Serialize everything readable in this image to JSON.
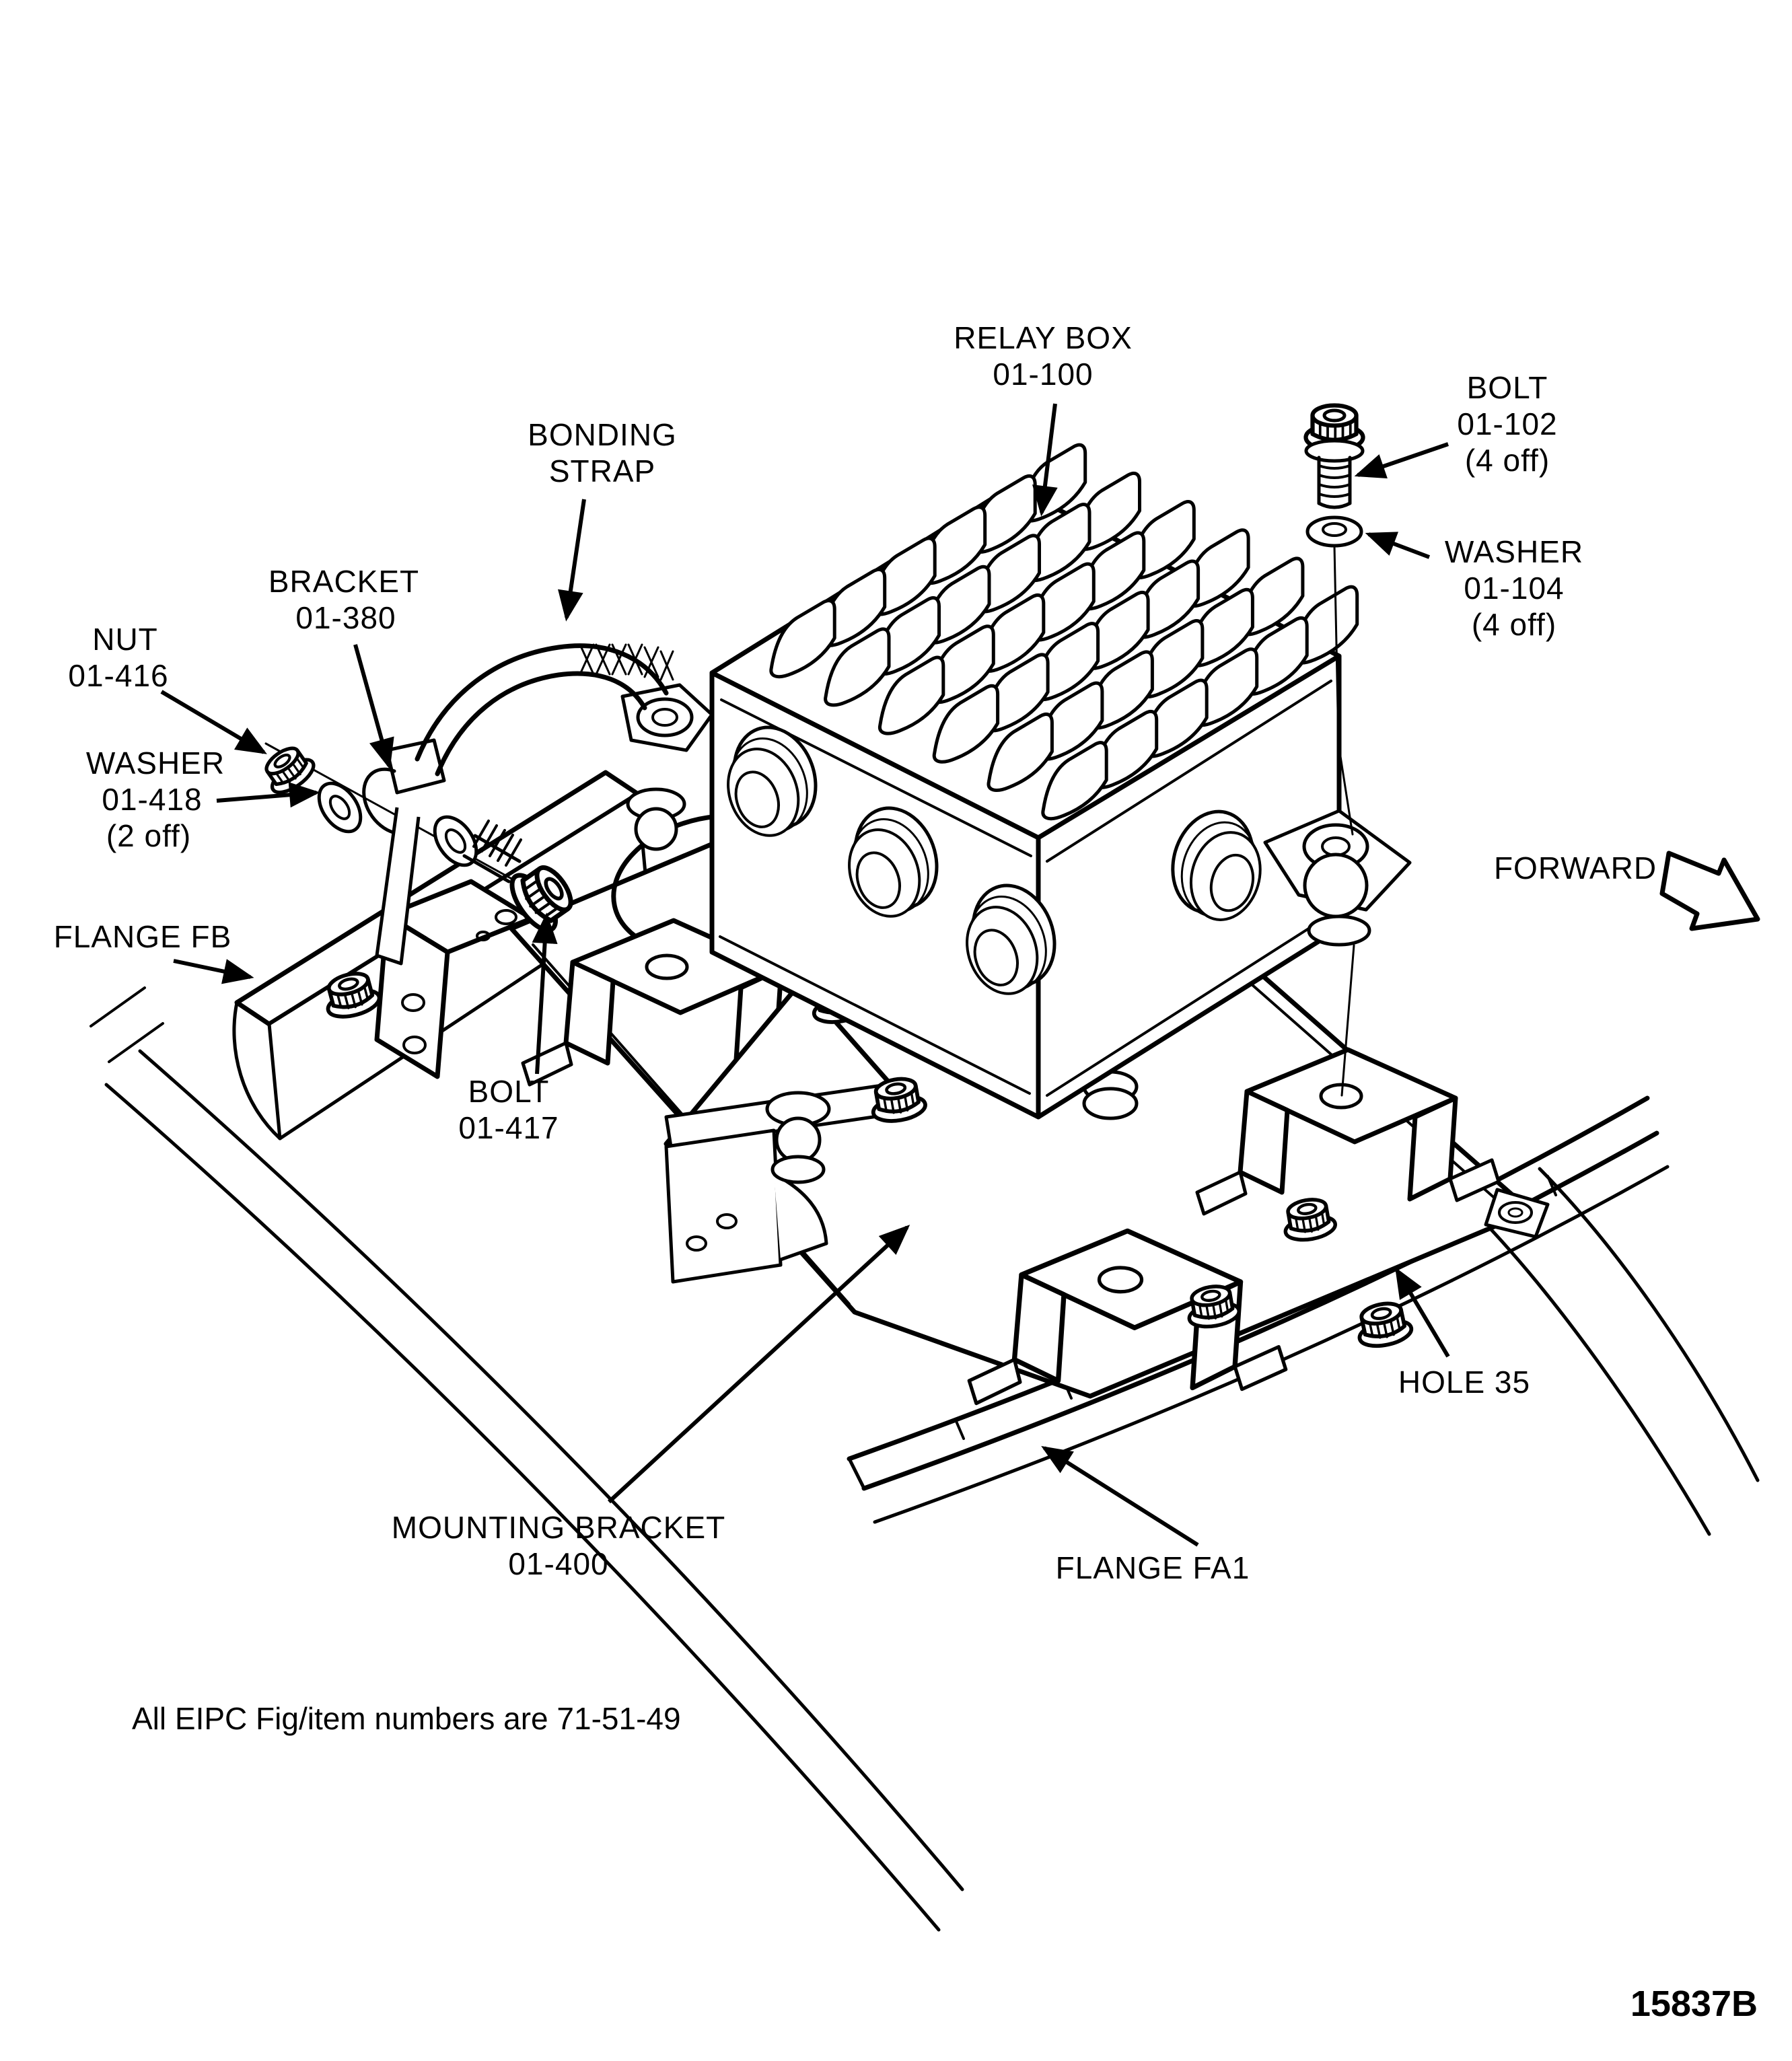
{
  "diagram": {
    "note": "All EIPC Fig/item numbers are  71-51-49",
    "figure_id": "15837B",
    "forward_label": "FORWARD",
    "colors": {
      "ink": "#000000",
      "paper": "#ffffff"
    },
    "icons": {
      "leader_arrowhead": "filled-triangle-arrow",
      "forward_arrow": "outline-block-arrow"
    }
  },
  "callouts": {
    "relay_box": {
      "line1": "RELAY BOX",
      "line2": "01-100"
    },
    "bolt_102": {
      "line1": "BOLT",
      "line2": "01-102",
      "line3": "(4 off)"
    },
    "washer_104": {
      "line1": "WASHER",
      "line2": "01-104",
      "line3": "(4 off)"
    },
    "bonding_strap": {
      "line1": "BONDING",
      "line2": "STRAP"
    },
    "bracket_380": {
      "line1": "BRACKET",
      "line2": "01-380"
    },
    "nut_416": {
      "line1": "NUT",
      "line2": "01-416"
    },
    "washer_418": {
      "line1": "WASHER",
      "line2": "01-418",
      "line3": "(2 off)"
    },
    "flange_fb": {
      "line1": "FLANGE FB"
    },
    "bolt_417": {
      "line1": "BOLT",
      "line2": "01-417"
    },
    "mounting_bracket": {
      "line1": "MOUNTING BRACKET",
      "line2": "01-400"
    },
    "hole_35": {
      "line1": "HOLE 35"
    },
    "flange_fa1": {
      "line1": "FLANGE FA1"
    }
  }
}
